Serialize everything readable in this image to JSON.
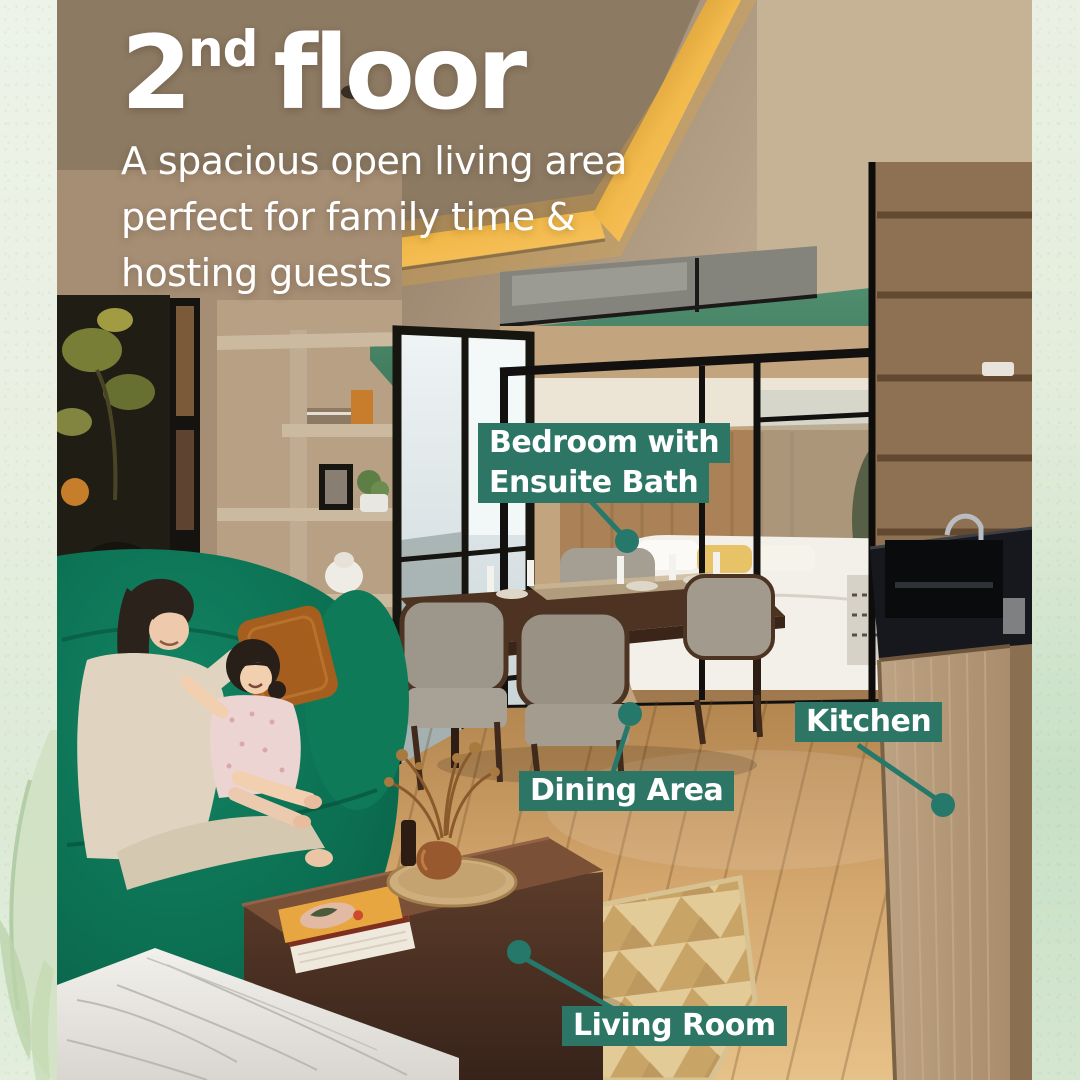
{
  "title": {
    "number": "2",
    "ordinal": "nd",
    "word": "floor"
  },
  "subtitle": {
    "lines": [
      "A spacious open living area",
      "perfect for family time &",
      "hosting guests"
    ]
  },
  "callouts": {
    "bedroom": {
      "line1": "Bedroom with",
      "line2": "Ensuite Bath"
    },
    "dining": {
      "label": "Dining Area"
    },
    "kitchen": {
      "label": "Kitchen"
    },
    "living": {
      "label": "Living Room"
    }
  },
  "colors": {
    "callout_background": "#2d7565",
    "connector_green": "#26786a",
    "label_text": "#ffffff",
    "paper_border": "#ecf2e6",
    "gold_cove_light": "#e8a83c",
    "green_feature_wall": "#47826a",
    "sofa_emerald": "#0d7355"
  }
}
